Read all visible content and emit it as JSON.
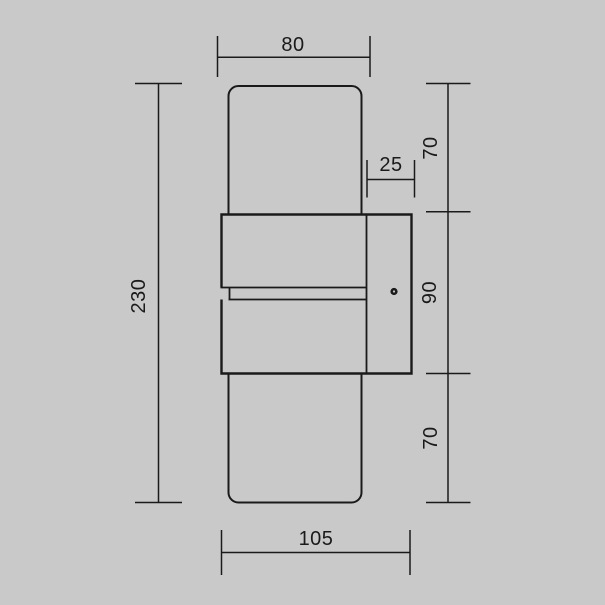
{
  "drawing": {
    "type": "technical-dimension-drawing",
    "subject": "wall lamp side profile with mounting bracket and light slot",
    "colors": {
      "background": "#c9c9c9",
      "line": "#1a1a1a"
    },
    "icons": {
      "screw": "filled-circle-with-center-dot"
    },
    "dimensions": {
      "top_width": "80",
      "overall_height": "230",
      "upper_section_height": "70",
      "bracket_depth": "25",
      "body_section_height": "90",
      "lower_section_height": "70",
      "bottom_width": "105"
    }
  }
}
